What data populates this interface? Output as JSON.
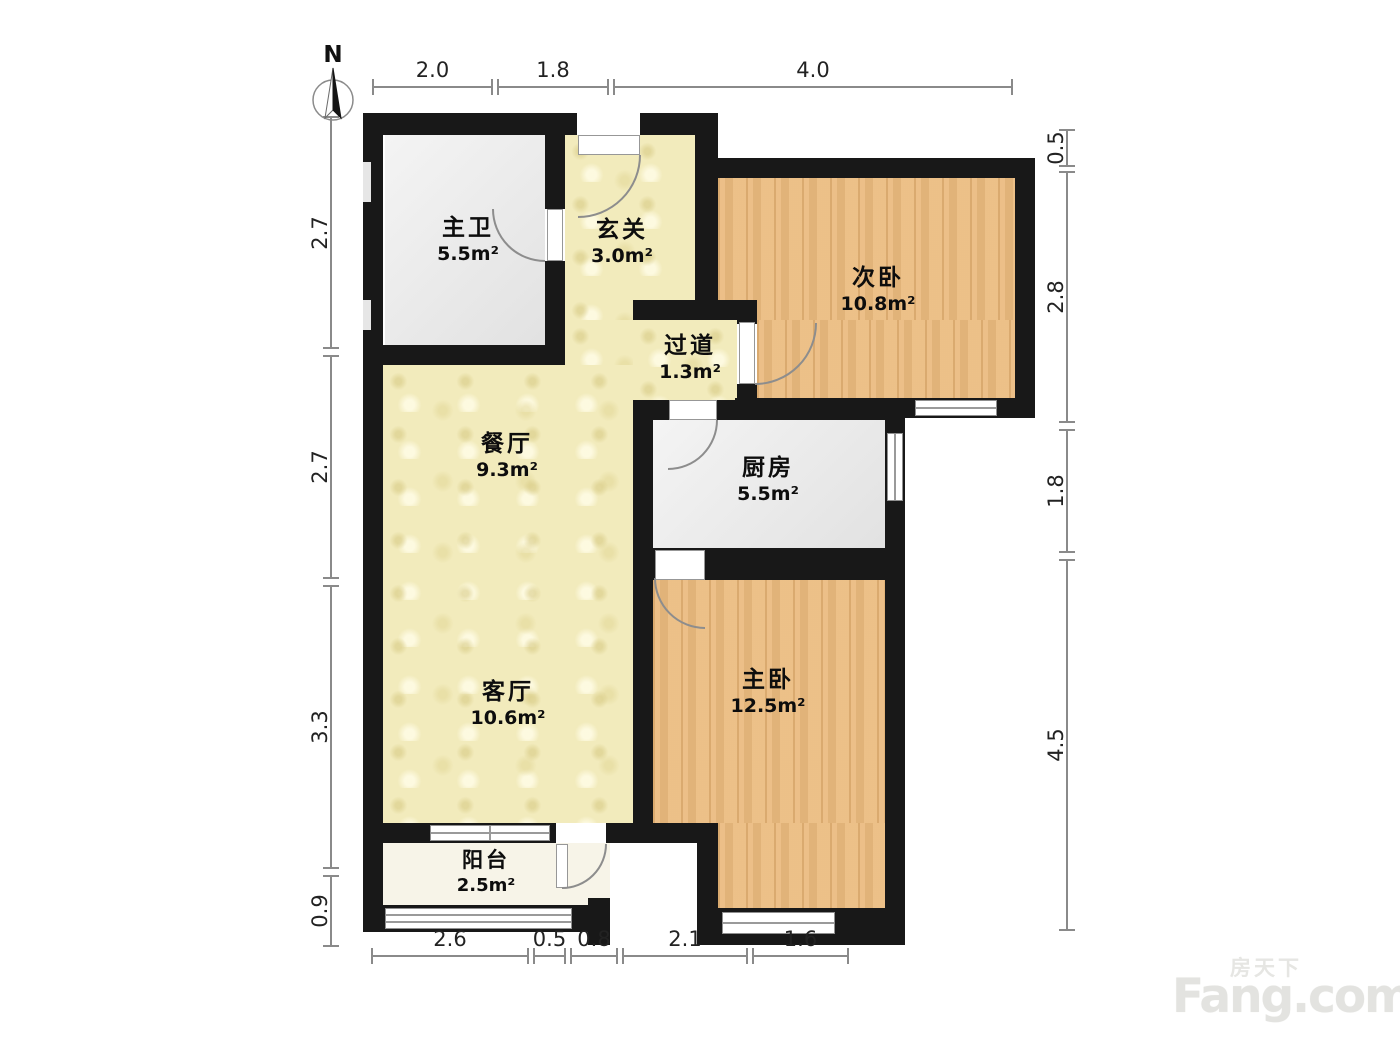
{
  "compass": {
    "label": "N"
  },
  "rooms": [
    {
      "id": "bathroom",
      "name": "主卫",
      "area": "5.5m²"
    },
    {
      "id": "entry-hall",
      "name": "玄关",
      "area": "3.0m²"
    },
    {
      "id": "secondary-bedroom",
      "name": "次卧",
      "area": "10.8m²"
    },
    {
      "id": "corridor",
      "name": "过道",
      "area": "1.3m²"
    },
    {
      "id": "dining-room",
      "name": "餐厅",
      "area": "9.3m²"
    },
    {
      "id": "kitchen",
      "name": "厨房",
      "area": "5.5m²"
    },
    {
      "id": "living-room",
      "name": "客厅",
      "area": "10.6m²"
    },
    {
      "id": "master-bedroom",
      "name": "主卧",
      "area": "12.5m²"
    },
    {
      "id": "balcony",
      "name": "阳台",
      "area": "2.5m²"
    }
  ],
  "dimensions": {
    "top": [
      "2.0",
      "1.8",
      "4.0"
    ],
    "bottom": [
      "2.6",
      "0.5",
      "0.8",
      "2.1",
      "1.6"
    ],
    "left": [
      "2.7",
      "2.7",
      "3.3",
      "0.9"
    ],
    "right": [
      "0.5",
      "2.8",
      "1.8",
      "4.5"
    ]
  },
  "watermark": {
    "cn": "房天下",
    "en": "Fang.com"
  },
  "palette": {
    "wall": "#181818",
    "wood_floor": "#eaba7e",
    "tile_floor": "#f2ebbc",
    "gray_floor": "#e9e9e9",
    "balcony_floor": "#f7f4e8",
    "dimension_line": "#8a8a8a",
    "watermark_gray": "#e3e3e0"
  }
}
